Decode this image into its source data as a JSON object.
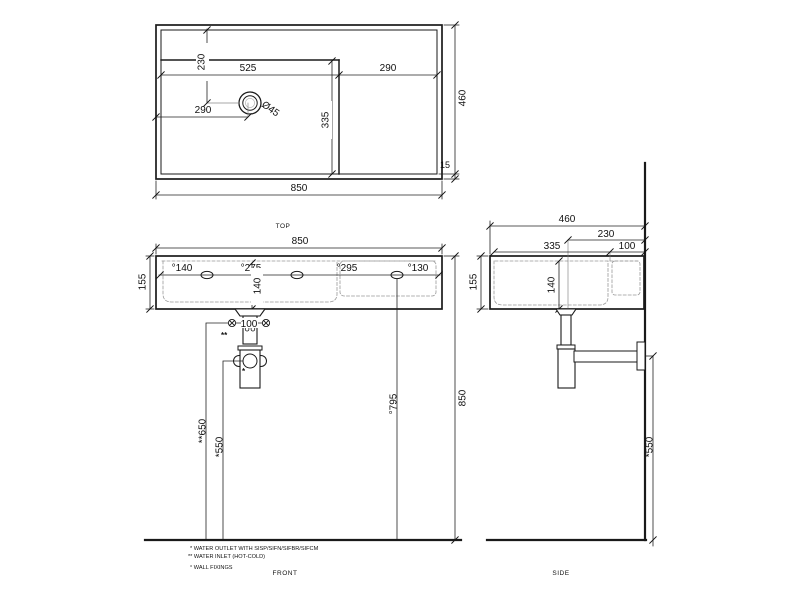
{
  "view_labels": {
    "top": "TOP",
    "front": "FRONT",
    "side": "SIDE"
  },
  "top_view": {
    "overall_width": "850",
    "overall_depth": "460",
    "rim_offset": "15",
    "tap_hole_from_back": "230",
    "bowl_width": "525",
    "deck_width": "290",
    "tap_hole_from_left": "290",
    "tap_hole_diameter": "Ø45",
    "bowl_depth": "335"
  },
  "front_view": {
    "overall_width": "850",
    "height": "155",
    "fixing_dim_1": "°140",
    "fixing_dim_2": "°275",
    "fixing_dim_3": "°295",
    "fixing_dim_4": "°130",
    "bowl_inner_height": "140",
    "inlet_spacing": "100",
    "inlet_mark": "**",
    "outlet_mark": "*",
    "inlet_height": "**650",
    "outlet_height": "*550",
    "fixing_height": "°795",
    "overall_height": "850"
  },
  "side_view": {
    "overall_depth": "460",
    "drain_to_wall": "230",
    "bowl_inner_depth": "335",
    "back_shelf": "100",
    "height": "155",
    "bowl_inner_height": "140",
    "outlet_height": "*550"
  },
  "notes": {
    "outlet": "*  WATER OUTLET WITH SISP/SIFN/SIFBR/SIFCM",
    "inlet": "** WATER INLET  (HOT-COLD)",
    "fixings": "°  WALL FIXINGS"
  }
}
